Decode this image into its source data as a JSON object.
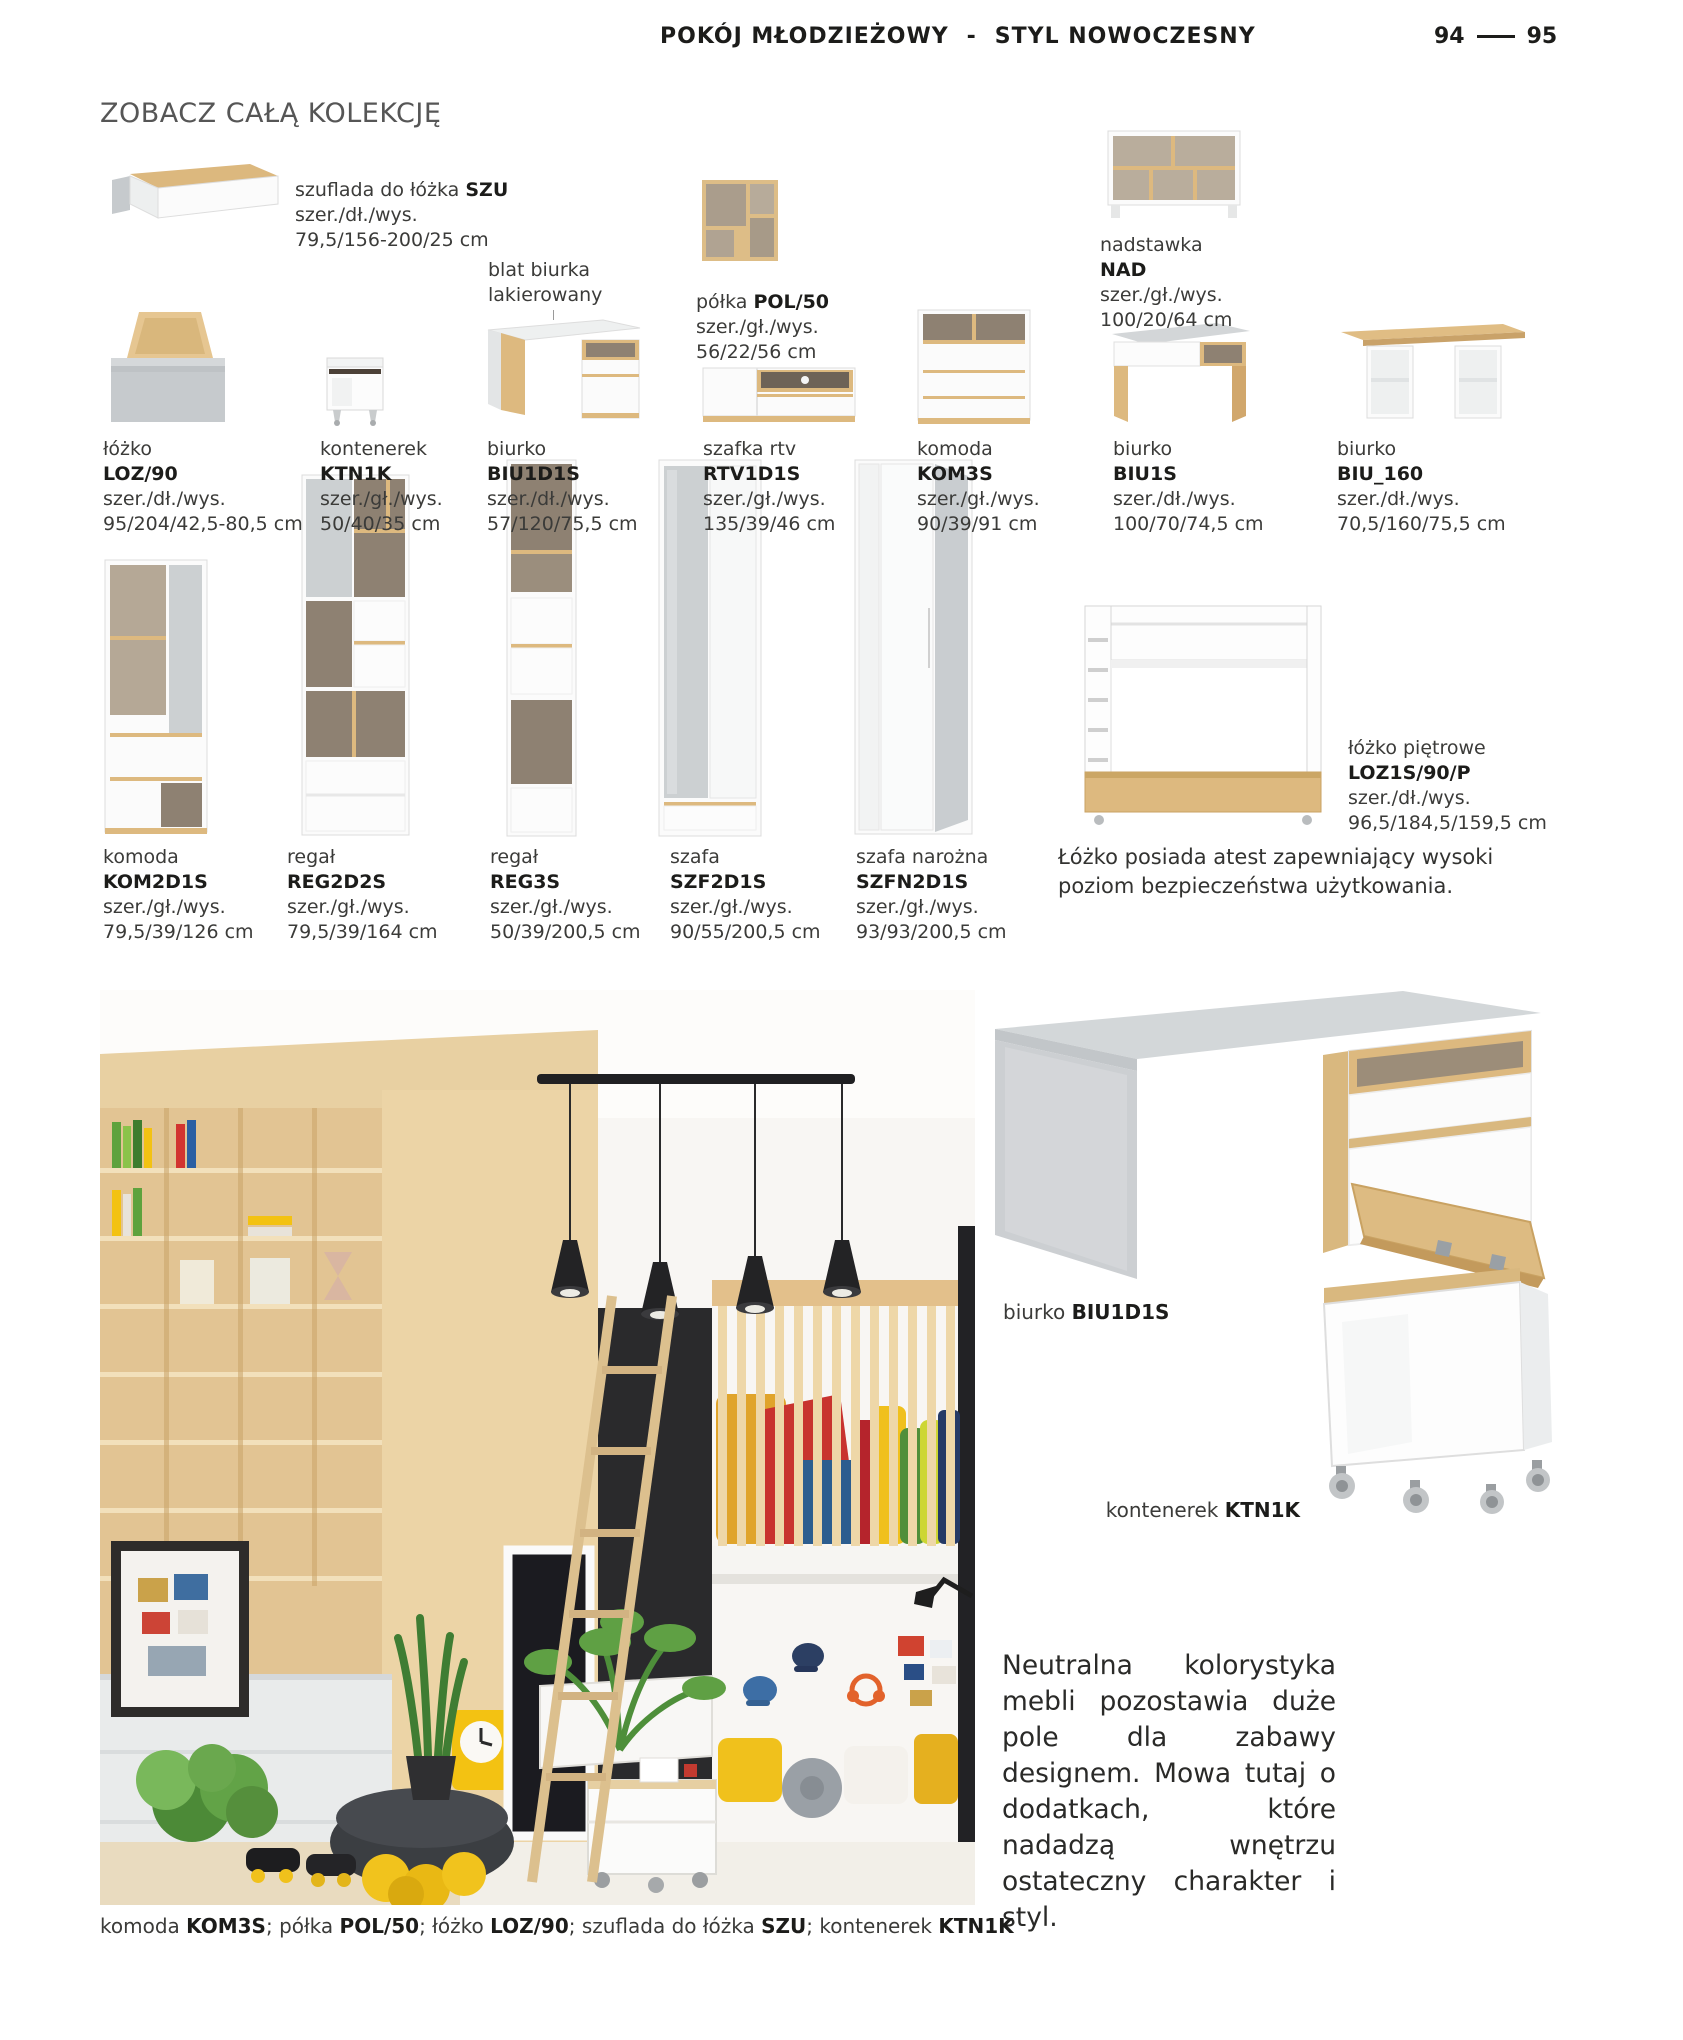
{
  "header": {
    "title_left": "POKÓJ MŁODZIEŻOWY",
    "separator": "-",
    "title_right": "STYL NOWOCZESNY",
    "page_left": "94",
    "page_right": "95"
  },
  "collection_heading": "ZOBACZ CAŁĄ KOLEKCJĘ",
  "annotation": {
    "line1": "blat biurka",
    "line2": "lakierowany"
  },
  "products": [
    {
      "name": "szuflada do łóżka",
      "code": "SZU",
      "dims_label": "szer./dł./wys.",
      "dims": "79,5/156-200/25 cm"
    },
    {
      "name": "półka",
      "code": "POL/50",
      "dims_label": "szer./gł./wys.",
      "dims": "56/22/56 cm"
    },
    {
      "name": "nadstawka",
      "code": "NAD",
      "dims_label": "szer./gł./wys.",
      "dims": "100/20/64 cm"
    },
    {
      "name": "łóżko",
      "code": "LOZ/90",
      "dims_label": "szer./dł./wys.",
      "dims": "95/204/42,5-80,5 cm"
    },
    {
      "name": "kontenerek",
      "code": "KTN1K",
      "dims_label": "szer./gł./wys.",
      "dims": "50/40/35 cm"
    },
    {
      "name": "biurko",
      "code": "BIU1D1S",
      "dims_label": "szer./dł./wys.",
      "dims": "57/120/75,5 cm"
    },
    {
      "name": "szafka rtv",
      "code": "RTV1D1S",
      "dims_label": "szer./gł./wys.",
      "dims": "135/39/46 cm"
    },
    {
      "name": "komoda",
      "code": "KOM3S",
      "dims_label": "szer./gł./wys.",
      "dims": "90/39/91 cm"
    },
    {
      "name": "biurko",
      "code": "BIU1S",
      "dims_label": "szer./dł./wys.",
      "dims": "100/70/74,5 cm"
    },
    {
      "name": "biurko",
      "code": "BIU_160",
      "dims_label": "szer./dł./wys.",
      "dims": "70,5/160/75,5 cm"
    },
    {
      "name": "komoda",
      "code": "KOM2D1S",
      "dims_label": "szer./gł./wys.",
      "dims": "79,5/39/126 cm"
    },
    {
      "name": "regał",
      "code": "REG2D2S",
      "dims_label": "szer./gł./wys.",
      "dims": "79,5/39/164 cm"
    },
    {
      "name": "regał",
      "code": "REG3S",
      "dims_label": "szer./gł./wys.",
      "dims": "50/39/200,5 cm"
    },
    {
      "name": "szafa",
      "code": "SZF2D1S",
      "dims_label": "szer./gł./wys.",
      "dims": "90/55/200,5 cm"
    },
    {
      "name": "szafa narożna",
      "code": "SZFN2D1S",
      "dims_label": "szer./gł./wys.",
      "dims": "93/93/200,5 cm"
    },
    {
      "name": "łóżko piętrowe",
      "code": "LOZ1S/90/P",
      "dims_label": "szer./dł./wys.",
      "dims": "96,5/184,5/159,5 cm"
    }
  ],
  "bunk_note": {
    "line1": "Łóżko posiada atest zapewniający wysoki",
    "line2": "poziom bezpieczeństwa użytkowania."
  },
  "photo_labels": {
    "desk_name": "biurko",
    "desk_code": "BIU1D1S",
    "container_name": "kontenerek",
    "container_code": "KTN1K"
  },
  "paragraph": "Neutralna kolorystyka mebli pozostawia duże pole dla zabawy designem. Mowa tutaj o dodatkach, które nadadzą wnętrzu ostateczny charakter i styl.",
  "caption": {
    "p1": "komoda ",
    "c1": "KOM3S",
    "p2": "; półka ",
    "c2": "POL/50",
    "p3": "; łóżko ",
    "c3": "LOZ/90",
    "p4": "; szuflada do łóżka ",
    "c4": "SZU",
    "p5": "; kontenerek ",
    "c5": "KTN1K"
  },
  "colors": {
    "wood": "#ddb97f",
    "gray_furniture": "#c9cdd0",
    "accent_yellow": "#f2c11c",
    "ink": "#1c1c1a"
  }
}
